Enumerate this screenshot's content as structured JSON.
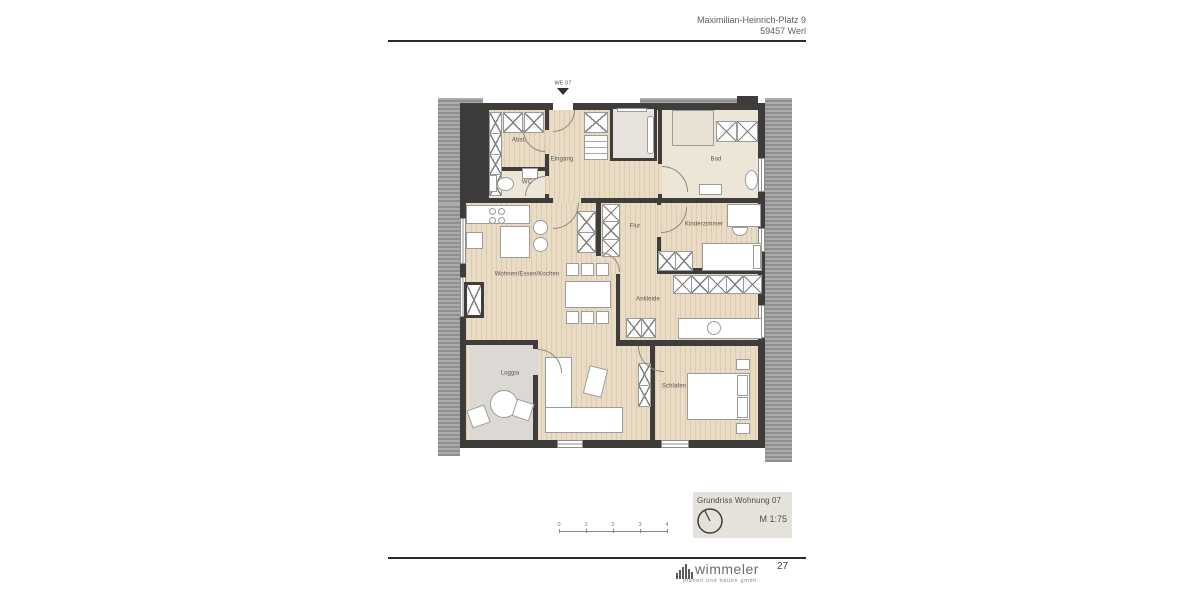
{
  "header": {
    "address_line1": "Maximilian-Heinrich-Platz 9",
    "address_line2": "59457 Werl"
  },
  "plan": {
    "entrance_marker": "WE 07",
    "entrance_icon": "entrance-arrow-icon",
    "rooms": {
      "abst": "Abst.",
      "eingang": "Eingang",
      "wc": "WC",
      "bad": "Bad",
      "flur": "Flur",
      "kinderzimmer": "Kinderzimmer",
      "wohnen": "Wohnen/Essen/Kochen",
      "ankleide": "Ankleide",
      "loggia": "Loggia",
      "schlafen": "Schlafen"
    }
  },
  "title_block": {
    "title": "Grundriss Wohnung 07",
    "scale": "M 1:75",
    "north_icon": "north-arrow-icon"
  },
  "scale_bar": {
    "ticks": [
      "0",
      "1",
      "2",
      "3",
      "4"
    ]
  },
  "footer": {
    "logo_icon": "logo-bars-icon",
    "logo_text": "wimmeler",
    "logo_subtext": "planen und bauen gmbh",
    "page_number": "27"
  },
  "colors": {
    "wall": "#3e3d3b",
    "wood_floor": "#e9dbc4",
    "bath_floor": "#ede5d6",
    "loggia_floor": "#dcd9d4",
    "roof_hatch": "#9e9e9e",
    "title_block_bg": "#e5e2dc"
  }
}
